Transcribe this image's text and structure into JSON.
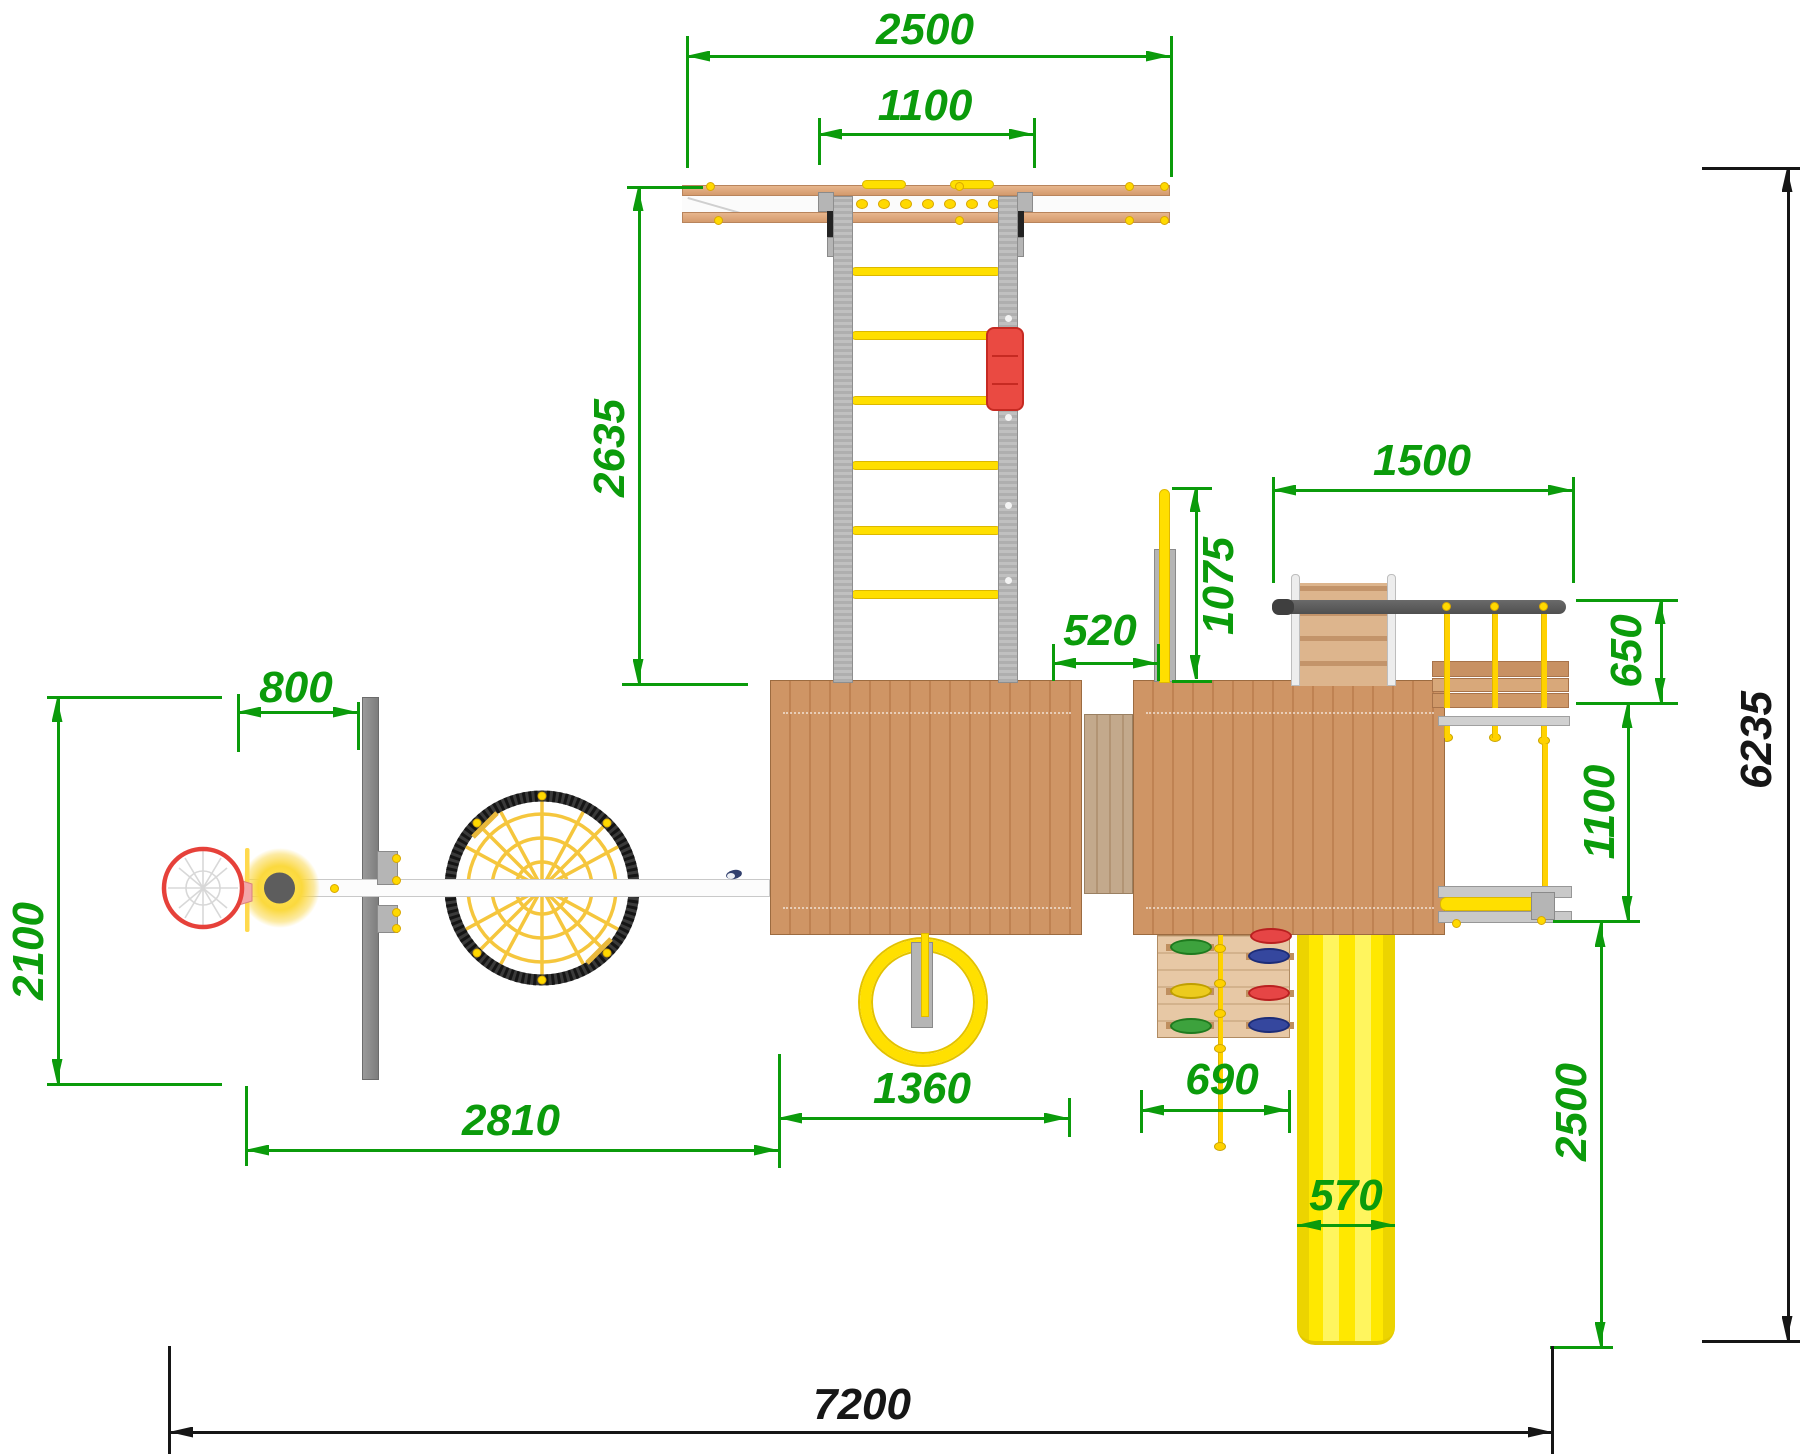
{
  "drawing": {
    "type": "playground-equipment-top-view",
    "units": "mm"
  },
  "colors": {
    "dimension_green": "#0b9b0b",
    "dimension_black": "#161616",
    "wood_platform": "#cf9565",
    "wood_rail": "#e0ab83",
    "metal_gray": "#b7b7b7",
    "metal_dark": "#565656",
    "accent_yellow": "#ffdf00",
    "slide_yellow": "#ffe800",
    "accent_red": "#e8443c",
    "hold_green": "#3da23d",
    "hold_blue": "#35479e",
    "hold_red": "#e64545",
    "hold_yellow": "#eccb1e"
  },
  "dimensions": [
    {
      "id": "beam-span",
      "label": "2500",
      "color": "green",
      "x1": 686,
      "y1": 56,
      "x2": 1170,
      "y2": 56,
      "lx": 925,
      "ly": 30,
      "rot": 0,
      "ticks": [
        [
          686,
          36,
          686,
          168
        ],
        [
          1170,
          36,
          1170,
          177
        ]
      ]
    },
    {
      "id": "ladder-width",
      "label": "1100",
      "color": "green",
      "x1": 818,
      "y1": 134,
      "x2": 1033,
      "y2": 134,
      "lx": 925,
      "ly": 106,
      "rot": 0,
      "ticks": [
        [
          818,
          118,
          818,
          165
        ],
        [
          1033,
          118,
          1033,
          168
        ]
      ]
    },
    {
      "id": "ladder-length",
      "label": "2635",
      "color": "green",
      "x1": 638,
      "y1": 187,
      "x2": 638,
      "y2": 683,
      "lx": 610,
      "ly": 448,
      "rot": -90,
      "ticks": [
        [
          627,
          186,
          703,
          186
        ],
        [
          622,
          683,
          748,
          683
        ]
      ]
    },
    {
      "id": "bridge-span",
      "label": "1500",
      "color": "green",
      "x1": 1272,
      "y1": 490,
      "x2": 1572,
      "y2": 490,
      "lx": 1422,
      "ly": 461,
      "rot": 0,
      "ticks": [
        [
          1272,
          477,
          1272,
          583
        ],
        [
          1572,
          477,
          1572,
          583
        ]
      ]
    },
    {
      "id": "pole-height",
      "label": "1075",
      "color": "green",
      "x1": 1195,
      "y1": 488,
      "x2": 1195,
      "y2": 679,
      "lx": 1219,
      "ly": 586,
      "rot": -90,
      "ticks": [
        [
          1172,
          487,
          1212,
          487
        ],
        [
          1172,
          680,
          1212,
          680
        ]
      ]
    },
    {
      "id": "deck-gap",
      "label": "520",
      "color": "green",
      "x1": 1052,
      "y1": 663,
      "x2": 1157,
      "y2": 663,
      "lx": 1100,
      "ly": 631,
      "rot": 0,
      "ticks": [
        [
          1052,
          644,
          1052,
          681
        ],
        [
          1157,
          644,
          1157,
          681
        ]
      ]
    },
    {
      "id": "bench-depth",
      "label": "650",
      "color": "green",
      "x1": 1660,
      "y1": 600,
      "x2": 1660,
      "y2": 702,
      "lx": 1627,
      "ly": 651,
      "rot": -90,
      "ticks": [
        [
          1576,
          599,
          1678,
          599
        ],
        [
          1576,
          702,
          1678,
          702
        ]
      ]
    },
    {
      "id": "bench-offset",
      "label": "1100",
      "color": "green",
      "x1": 1627,
      "y1": 704,
      "x2": 1627,
      "y2": 920,
      "lx": 1600,
      "ly": 812,
      "rot": -90,
      "ticks": [
        [
          1553,
          920,
          1640,
          920
        ]
      ]
    },
    {
      "id": "slide-run",
      "label": "2500",
      "color": "green",
      "x1": 1600,
      "y1": 923,
      "x2": 1600,
      "y2": 1346,
      "lx": 1572,
      "ly": 1112,
      "rot": -90,
      "ticks": [
        [
          1550,
          1346,
          1613,
          1346
        ]
      ]
    },
    {
      "id": "total-depth",
      "label": "6235",
      "color": "black",
      "x1": 1787,
      "y1": 168,
      "x2": 1787,
      "y2": 1340,
      "lx": 1757,
      "ly": 740,
      "rot": -90,
      "ticks": [
        [
          1702,
          167,
          1800,
          167
        ],
        [
          1702,
          1340,
          1800,
          1340
        ]
      ]
    },
    {
      "id": "total-width",
      "label": "7200",
      "color": "black",
      "x1": 169,
      "y1": 1432,
      "x2": 1552,
      "y2": 1432,
      "lx": 862,
      "ly": 1405,
      "rot": 0,
      "ticks": [
        [
          168,
          1346,
          168,
          1454
        ],
        [
          1551,
          1346,
          1551,
          1454
        ]
      ]
    },
    {
      "id": "hoop-offset",
      "label": "800",
      "color": "green",
      "x1": 237,
      "y1": 712,
      "x2": 357,
      "y2": 712,
      "lx": 296,
      "ly": 688,
      "rot": 0,
      "ticks": [
        [
          237,
          694,
          237,
          752
        ],
        [
          357,
          702,
          357,
          750
        ]
      ]
    },
    {
      "id": "swing-frame",
      "label": "2100",
      "color": "green",
      "x1": 57,
      "y1": 698,
      "x2": 57,
      "y2": 1083,
      "lx": 29,
      "ly": 951,
      "rot": -90,
      "ticks": [
        [
          47,
          696,
          222,
          696
        ],
        [
          47,
          1083,
          222,
          1083
        ]
      ]
    },
    {
      "id": "swing-span",
      "label": "2810",
      "color": "green",
      "x1": 245,
      "y1": 1150,
      "x2": 778,
      "y2": 1150,
      "lx": 511,
      "ly": 1121,
      "rot": 0,
      "ticks": [
        [
          245,
          1086,
          245,
          1166
        ],
        [
          778,
          1054,
          778,
          1168
        ]
      ]
    },
    {
      "id": "ring-offset",
      "label": "1360",
      "color": "green",
      "x1": 778,
      "y1": 1118,
      "x2": 1068,
      "y2": 1118,
      "lx": 922,
      "ly": 1089,
      "rot": 0,
      "ticks": [
        [
          1068,
          1098,
          1068,
          1137
        ]
      ]
    },
    {
      "id": "wall-width",
      "label": "690",
      "color": "green",
      "x1": 1140,
      "y1": 1110,
      "x2": 1288,
      "y2": 1110,
      "lx": 1222,
      "ly": 1080,
      "rot": 0,
      "ticks": [
        [
          1140,
          1090,
          1140,
          1133
        ],
        [
          1288,
          1090,
          1288,
          1133
        ]
      ]
    },
    {
      "id": "slide-width",
      "label": "570",
      "color": "green",
      "x1": 1297,
      "y1": 1225,
      "x2": 1395,
      "y2": 1225,
      "lx": 1346,
      "ly": 1196,
      "rot": 0,
      "ticks": []
    }
  ]
}
